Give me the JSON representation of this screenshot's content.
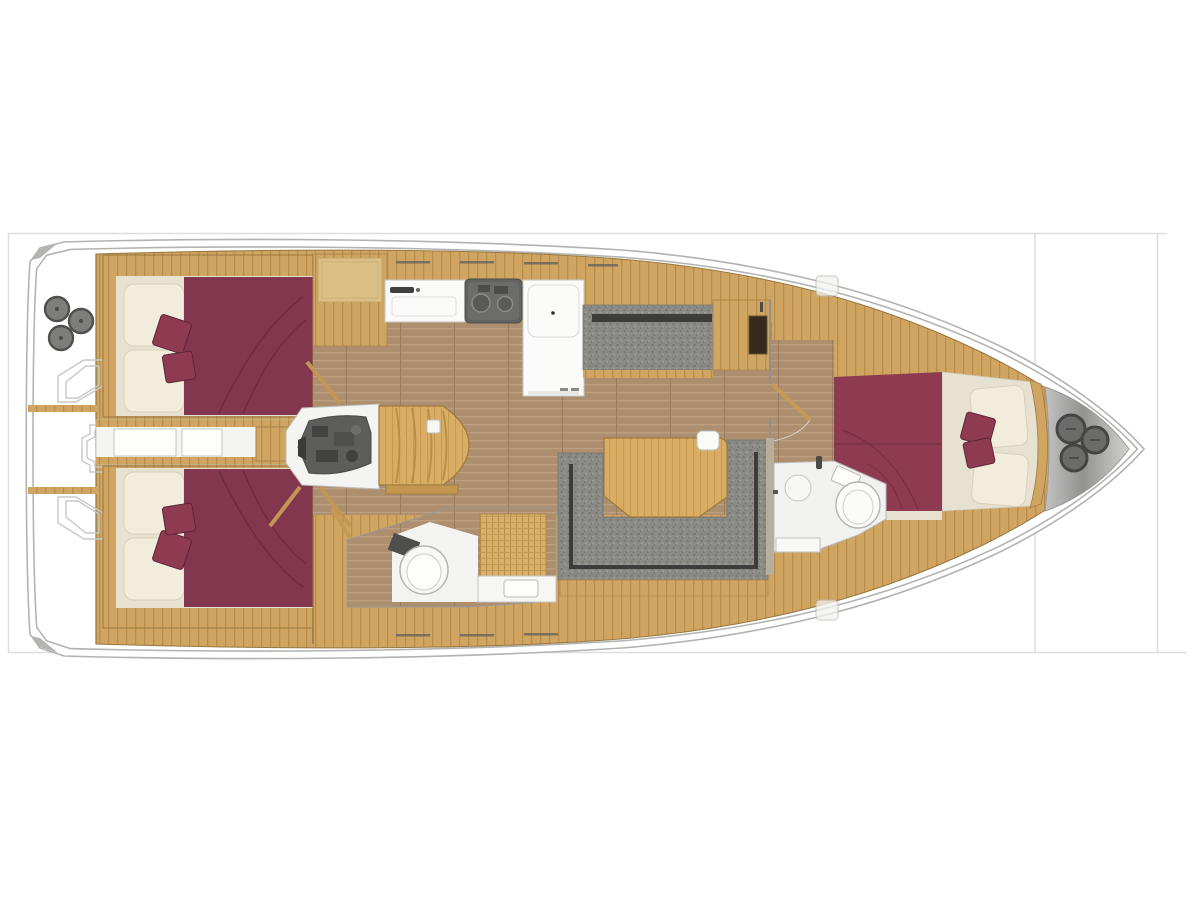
{
  "meta": {
    "description": "Top-view interior floor plan of a sailing yacht, bow pointing right, no text labels",
    "diagram_type": "yacht-floor-plan"
  },
  "colors": {
    "background": "#ffffff",
    "frame-line": "#dedede",
    "hull-outline": "#b2b2b0",
    "hull-inner-line": "#c9c9c7",
    "hull-fill": "#ffffff",
    "wood": "#d0a561",
    "wood-line": "#b98e4c",
    "wood-edge": "#97773f",
    "wood-light": "#dcbf86",
    "floor": "#ad8e6f",
    "floor-line": "#bd9e7e",
    "upholstery": "#8a8a86",
    "upholstery-dot-dark": "#77776f",
    "upholstery-dot-light": "#9d9d95",
    "upholstery-piping": "#3c3c3a",
    "mattress-aft": "#82374e",
    "mattress-fwd": "#8e3b52",
    "mattress-seam": "#6e2b3f",
    "pillow-cream": "#f2ecdc",
    "pillow-cream-edge": "#d8d0ba",
    "berth-base": "#e7e1d1",
    "wall-taupe": "#b7ae9d",
    "fixture-white": "#f4f4f2",
    "fixture-outline": "#c0c0be",
    "engine": "#5d5d5b",
    "engine-dark": "#434341",
    "appliance": "#646462",
    "locker-slot": "#352a1c",
    "hatch-circle": "#6b6b69",
    "hatch-circle-rim": "#454543"
  },
  "regions": [
    {
      "id": "stern-hatches",
      "label": "Stern locker hatches"
    },
    {
      "id": "aft-cockpit",
      "label": "Aft cockpit"
    },
    {
      "id": "aft-cabin-port",
      "label": "Aft double cabin, port side"
    },
    {
      "id": "aft-cabin-stbd",
      "label": "Aft double cabin, starboard side"
    },
    {
      "id": "aft-passage",
      "label": "Aft passage between cabins"
    },
    {
      "id": "engine-room",
      "label": "Engine compartment"
    },
    {
      "id": "companionway",
      "label": "Companionway steps"
    },
    {
      "id": "galley-sink",
      "label": "Galley sink unit"
    },
    {
      "id": "galley-stove",
      "label": "Galley stove"
    },
    {
      "id": "galley-fridge",
      "label": "Galley refrigerator unit"
    },
    {
      "id": "salon-settee",
      "label": "Port salon settee"
    },
    {
      "id": "dinette",
      "label": "U-shaped dinette seating"
    },
    {
      "id": "salon-table",
      "label": "Salon table"
    },
    {
      "id": "aft-head",
      "label": "Aft head with toilet and shower"
    },
    {
      "id": "fwd-head",
      "label": "Forward head with toilet"
    },
    {
      "id": "fwd-cabin",
      "label": "Forward V-berth cabin"
    },
    {
      "id": "anchor-locker",
      "label": "Bow anchor locker with deck hatches"
    }
  ]
}
